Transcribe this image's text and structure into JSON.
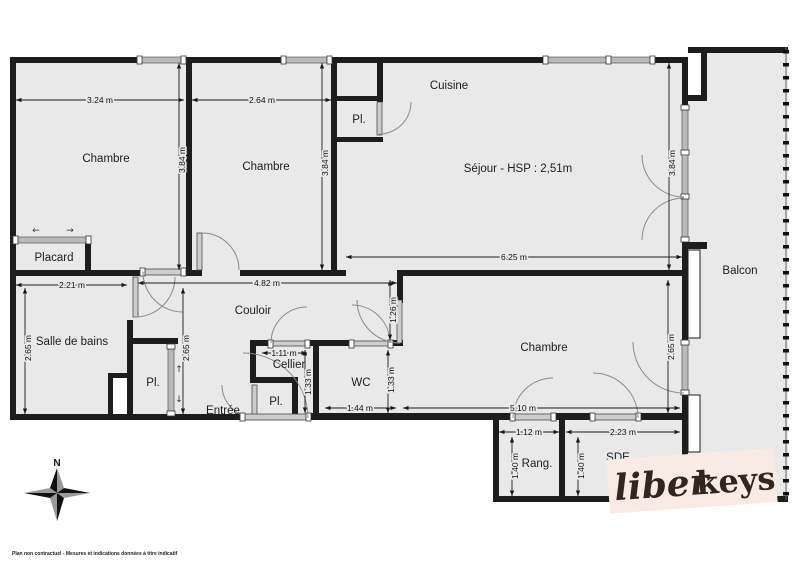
{
  "labels": {
    "bedroom1": "Chambre",
    "bedroom2": "Chambre",
    "bedroom3": "Chambre",
    "kitchen": "Cuisine",
    "living": "Séjour - HSP : 2,51m",
    "closet": "Placard",
    "closet_kitchen": "Pl.",
    "closet_bath": "Pl.",
    "closet_entry": "Pl.",
    "bathroom": "Salle de bains",
    "hallway": "Couloir",
    "pantry": "Cellier",
    "wc": "WC",
    "entry": "Entrée",
    "balcony": "Balcon",
    "storage": "Rang.",
    "shower_room": "SDE"
  },
  "dims": {
    "d_3_24": "3.24 m",
    "d_2_64": "2.64 m",
    "d_6_25": "6.25 m",
    "d_2_21": "2.21 m",
    "d_4_82": "4.82 m",
    "d_1_11": "1.11 m",
    "d_1_44": "1.44 m",
    "d_5_10": "5.10 m",
    "d_1_12": "1.12 m",
    "d_2_23": "2.23 m",
    "d_3_84_a": "3.84 m",
    "d_3_84_b": "3.84 m",
    "d_3_84_c": "3.84 m",
    "d_2_65_a": "2.65 m",
    "d_2_65_b": "2.65 m",
    "d_2_65_c": "2.65 m",
    "d_1_26": "1.26 m",
    "d_1_33_a": "1.33 m",
    "d_1_33_b": "1.33 m",
    "d_1_40_a": "1.40 m",
    "d_1_40_b": "1.40 m"
  },
  "glyphs": {
    "slide_left": "←",
    "slide_right": "→",
    "slide_up": "↑",
    "slide_down": "↓"
  },
  "compass": {
    "north": "N"
  },
  "footer": {
    "disclaimer": "Plan non contractuel - Mesures et indications données à titre indicatif"
  },
  "logo": {
    "script": "liber",
    "bold": "keys"
  },
  "colors": {
    "wall": "#1d1d1b",
    "floor": "#e9e9e9",
    "window_bar": "#b9b9b9",
    "door_leaf": "#cdcdcd",
    "arc": "#8a8a8a",
    "dim": "#1a1a1a",
    "text": "#1c1c1c",
    "logo_bg": "#f8ebe5",
    "logo_text": "#2f2621"
  }
}
